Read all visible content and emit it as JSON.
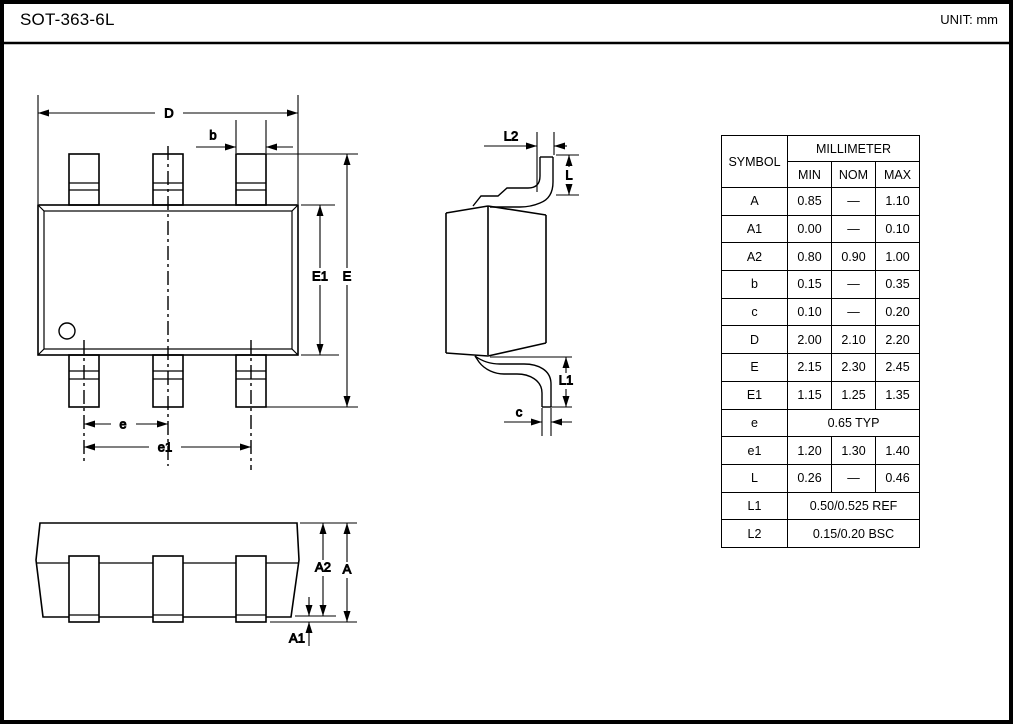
{
  "page": {
    "title": "SOT-363-6L",
    "unit_label": "UNIT: mm"
  },
  "labels": {
    "D": "D",
    "b": "b",
    "E": "E",
    "E1": "E1",
    "e": "e",
    "e1": "e1",
    "L2": "L2",
    "L": "L",
    "L1": "L1",
    "c": "c",
    "A2": "A2",
    "A": "A",
    "A1": "A1"
  },
  "table": {
    "symbol_header": "SYMBOL",
    "unit_header": "MILLIMETER",
    "columns": [
      "MIN",
      "NOM",
      "MAX"
    ],
    "rows": [
      {
        "symbol": "A",
        "min": "0.85",
        "nom": "—",
        "max": "1.10"
      },
      {
        "symbol": "A1",
        "min": "0.00",
        "nom": "—",
        "max": "0.10"
      },
      {
        "symbol": "A2",
        "min": "0.80",
        "nom": "0.90",
        "max": "1.00"
      },
      {
        "symbol": "b",
        "min": "0.15",
        "nom": "—",
        "max": "0.35"
      },
      {
        "symbol": "c",
        "min": "0.10",
        "nom": "—",
        "max": "0.20"
      },
      {
        "symbol": "D",
        "min": "2.00",
        "nom": "2.10",
        "max": "2.20"
      },
      {
        "symbol": "E",
        "min": "2.15",
        "nom": "2.30",
        "max": "2.45"
      },
      {
        "symbol": "E1",
        "min": "1.15",
        "nom": "1.25",
        "max": "1.35"
      },
      {
        "symbol": "e",
        "value": "0.65 TYP"
      },
      {
        "symbol": "e1",
        "min": "1.20",
        "nom": "1.30",
        "max": "1.40"
      },
      {
        "symbol": "L",
        "min": "0.26",
        "nom": "—",
        "max": "0.46"
      },
      {
        "symbol": "L1",
        "value": "0.50/0.525 REF"
      },
      {
        "symbol": "L2",
        "value": "0.15/0.20 BSC"
      }
    ]
  }
}
